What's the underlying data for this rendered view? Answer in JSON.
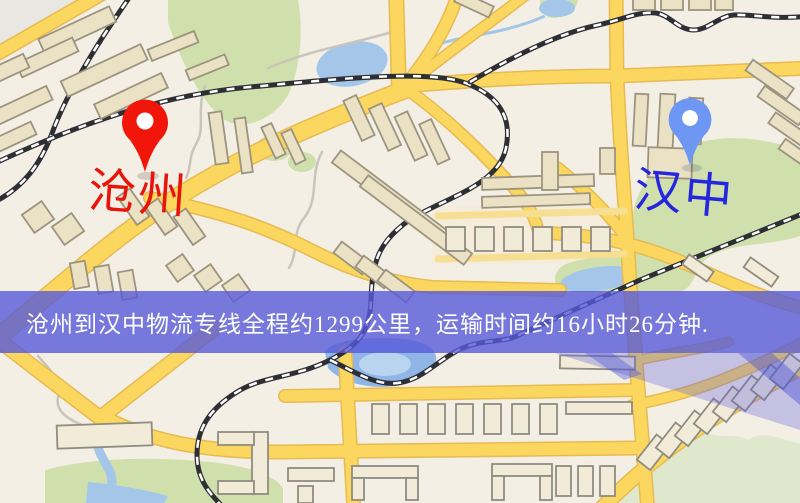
{
  "map": {
    "markers": {
      "origin": {
        "name": "沧州",
        "pin_color": "#f2150a",
        "label_color": "#e8150a"
      },
      "destination": {
        "name": "汉中",
        "pin_color": "#6d97f2",
        "label_color": "#2526dd"
      }
    },
    "banner": {
      "text": "沧州到汉中物流专线全程约1299公里，运输时间约16小时26分钟.",
      "background_color": "#585ada",
      "text_color": "#ffffff"
    },
    "palette": {
      "map_background": "#f3efe5",
      "road_fill": "#fbd75f",
      "road_casing": "#e7ba52",
      "park_green": "#cfe0ad",
      "hill_green": "#dfe8cc",
      "water_blue": "#a3c6e9",
      "railway_dark": "#2e2e35",
      "building_fill": "#ebe2c6",
      "building_outline": "#9c947e"
    }
  }
}
